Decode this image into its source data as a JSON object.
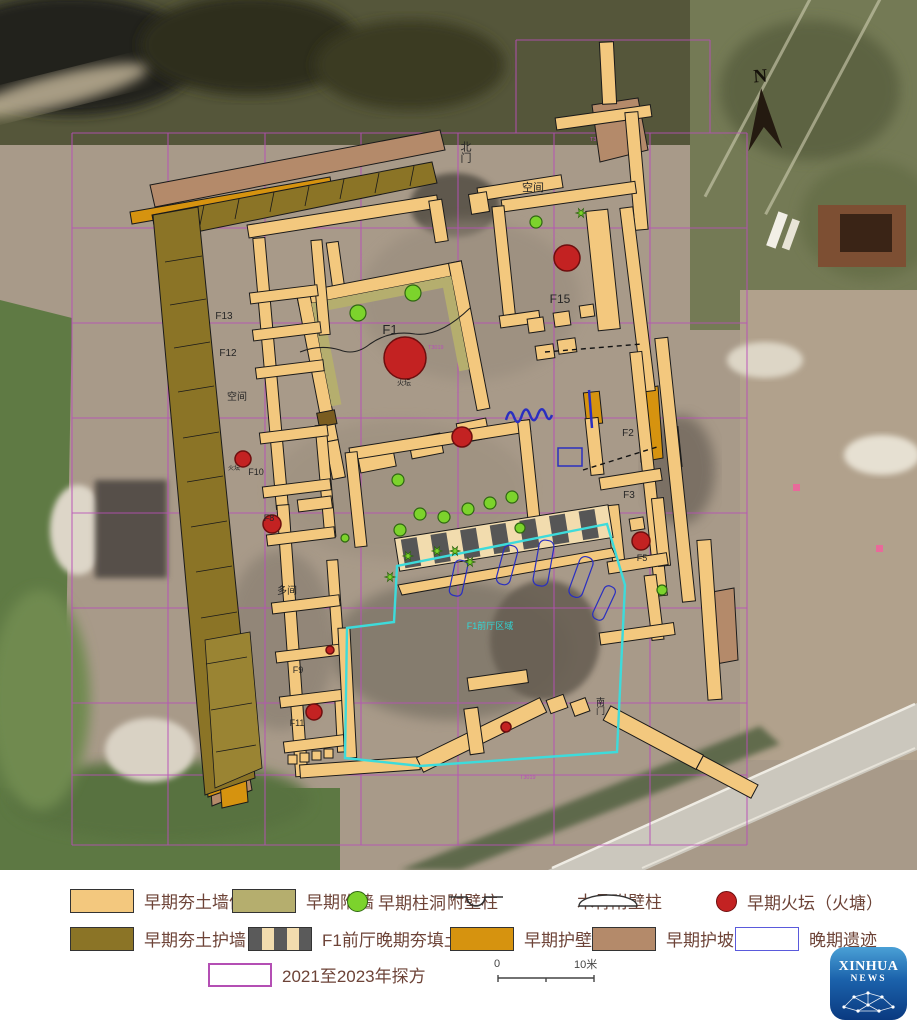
{
  "map": {
    "north": "N",
    "labels": {
      "north_gate": "北门",
      "south_gate": "南门",
      "space_top": "空间",
      "space_left": "空间",
      "space_mid": "多间",
      "f1": "F1",
      "f2": "F2",
      "f3": "F3",
      "f5": "F5",
      "f8": "F8",
      "f9": "F9",
      "f10": "F10",
      "f11": "F11",
      "f12": "F12",
      "f13": "F13",
      "f15": "F15",
      "fire_altar_f1": "火坛",
      "fire_altar_f10": "火坛",
      "front_hall": "F1前厅区域",
      "grid_a": "T3028",
      "grid_b": "T3019",
      "grid_c": "T3019"
    }
  },
  "legend": {
    "row1": [
      {
        "label": "早期夯土墙体"
      },
      {
        "label": "早期附墙"
      },
      {
        "label": "早期柱洞"
      },
      {
        "label": "附壁柱"
      },
      {
        "label": "木骨附壁柱"
      },
      {
        "label": "早期火坛（火塘）"
      }
    ],
    "row2": [
      {
        "label": "早期夯土护墙"
      },
      {
        "label": "F1前厅晚期夯填土"
      },
      {
        "label": "早期护壁"
      },
      {
        "label": "早期护坡"
      },
      {
        "label": "晚期遗迹"
      }
    ],
    "row3": [
      {
        "label": "2021至2023年探方"
      }
    ],
    "scale": {
      "start": "0",
      "end": "10米"
    }
  },
  "logo": {
    "line1": "XINHUA",
    "line2": "NEWS"
  },
  "colors": {
    "wall_tan": "#f3c87e",
    "attached_wall_olive": "#b5ae6e",
    "guard_wall_olive": "#8b7426",
    "guard_face_orange": "#d6930f",
    "slope_brown": "#b48a6a",
    "posthole_green": "#7cd32c",
    "fire_altar_red": "#c32222",
    "grid_purple": "#b44fb4",
    "late_remains_blue": "#5a5adc",
    "front_hall_cyan": "#3ddbdb"
  }
}
